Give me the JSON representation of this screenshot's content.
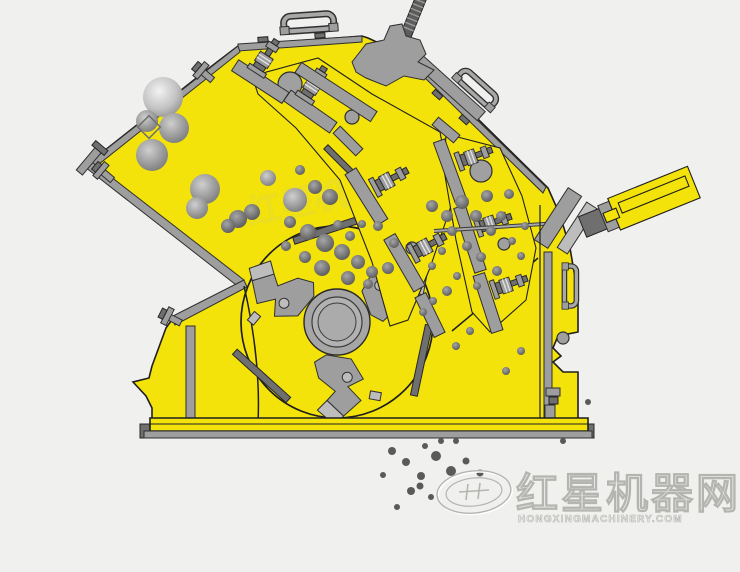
{
  "page": {
    "background": "#f0f0ee"
  },
  "diagram": {
    "subject": "impact crusher cross-section working principle illustration",
    "colors": {
      "background": "#f0f0ee",
      "body-yellow": "#f3e30b",
      "steel": "#9e9e9e",
      "steel-light": "#bdbdbd",
      "steel-dark": "#6f6f6f",
      "outline": "#1f1f1f",
      "rock": "#8a8a8a",
      "rock-dark": "#5a5a5a",
      "watermark-stroke": "#b4b4b0",
      "watermark-fill": "#ececea"
    },
    "parts": [
      "feed-inlet-chute",
      "upper-impact-curtain",
      "lower-impact-curtain",
      "curtain-spring-bolts",
      "rotor",
      "rotor-hub",
      "blow-bar-hammers",
      "hydraulic-adjusting-cylinder",
      "top-cover-handles",
      "machine-housing",
      "base-frame",
      "rock-particles",
      "crushed-product-discharge"
    ]
  },
  "watermark": {
    "brand_text": "红星机器网",
    "url_text": "HONGXINGMACHINERY.COM"
  }
}
